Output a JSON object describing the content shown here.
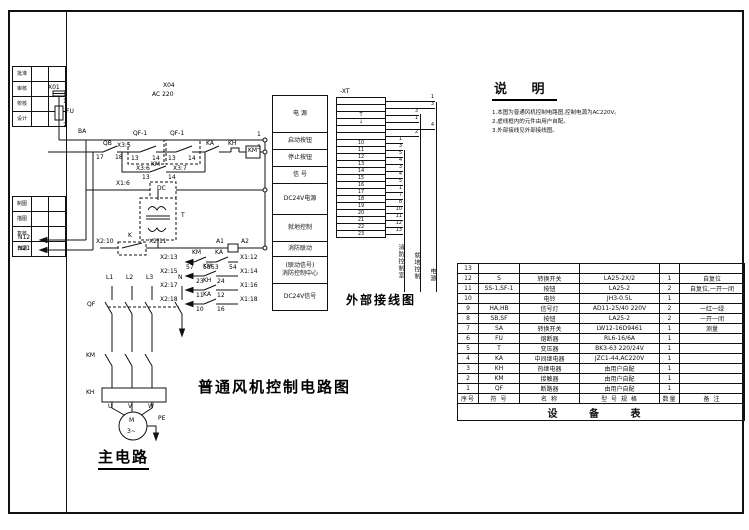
{
  "drawing": {
    "main_title": "普通风机控制电路图",
    "wiring_title": "外部接线图",
    "main_circuit_title": "主电路",
    "terminal_strip_name": "-XT"
  },
  "notes": {
    "title": "说 明",
    "lines": [
      "1.本图为普通风机控制电路图,控制电源为AC220V。",
      "2.虚线框内的元件由用户自配。",
      "3.外部接线见外部接线图。"
    ]
  },
  "labels": {
    "control": [
      {
        "t": "X01",
        "x": 48,
        "y": 85
      },
      {
        "t": "1",
        "x": 63,
        "y": 99
      },
      {
        "t": "FU",
        "x": 66,
        "y": 109
      },
      {
        "t": "2",
        "x": 63,
        "y": 123
      },
      {
        "t": "X04",
        "x": 163,
        "y": 83
      },
      {
        "t": "AC 220",
        "x": 152,
        "y": 92
      },
      {
        "t": "BA",
        "x": 78,
        "y": 129
      },
      {
        "t": "QB",
        "x": 103,
        "y": 141
      },
      {
        "t": "17",
        "x": 96,
        "y": 155
      },
      {
        "t": "18",
        "x": 115,
        "y": 155
      },
      {
        "t": "X3:5",
        "x": 117,
        "y": 143
      },
      {
        "t": "QF-1",
        "x": 133,
        "y": 131
      },
      {
        "t": "QF-1",
        "x": 170,
        "y": 131
      },
      {
        "t": "13",
        "x": 131,
        "y": 156
      },
      {
        "t": "14",
        "x": 152,
        "y": 156
      },
      {
        "t": "X3:6",
        "x": 136,
        "y": 166
      },
      {
        "t": "13",
        "x": 168,
        "y": 156
      },
      {
        "t": "14",
        "x": 188,
        "y": 156
      },
      {
        "t": "X3:7",
        "x": 173,
        "y": 166
      },
      {
        "t": "KA",
        "x": 206,
        "y": 141
      },
      {
        "t": "KH",
        "x": 228,
        "y": 141
      },
      {
        "t": "KM",
        "x": 248,
        "y": 148
      },
      {
        "t": "KM",
        "x": 151,
        "y": 162
      },
      {
        "t": "13",
        "x": 142,
        "y": 175
      },
      {
        "t": "14",
        "x": 168,
        "y": 175
      },
      {
        "t": "X1:6",
        "x": 116,
        "y": 181
      },
      {
        "t": "DC",
        "x": 157,
        "y": 186
      },
      {
        "t": "T",
        "x": 181,
        "y": 213
      },
      {
        "t": "X2:10",
        "x": 96,
        "y": 239
      },
      {
        "t": "K",
        "x": 128,
        "y": 233
      },
      {
        "t": "X2:11",
        "x": 149,
        "y": 239
      },
      {
        "t": "A1",
        "x": 216,
        "y": 239
      },
      {
        "t": "A2",
        "x": 241,
        "y": 239
      },
      {
        "t": "1",
        "x": 257,
        "y": 132
      },
      {
        "t": "3",
        "x": 257,
        "y": 145
      }
    ],
    "feedback": [
      {
        "t": "X2:13",
        "x": 160,
        "y": 255
      },
      {
        "t": "KM",
        "x": 192,
        "y": 250
      },
      {
        "t": "57",
        "x": 186,
        "y": 265
      },
      {
        "t": "58",
        "x": 203,
        "y": 265
      },
      {
        "t": "KA",
        "x": 215,
        "y": 250
      },
      {
        "t": "53",
        "x": 211,
        "y": 265
      },
      {
        "t": "54",
        "x": 229,
        "y": 265
      },
      {
        "t": "X1:12",
        "x": 240,
        "y": 255
      },
      {
        "t": "X2:15",
        "x": 160,
        "y": 269
      },
      {
        "t": "KM",
        "x": 203,
        "y": 264
      },
      {
        "t": "23",
        "x": 196,
        "y": 279
      },
      {
        "t": "24",
        "x": 217,
        "y": 279
      },
      {
        "t": "X1:14",
        "x": 240,
        "y": 269
      },
      {
        "t": "X2:17",
        "x": 160,
        "y": 283
      },
      {
        "t": "KH",
        "x": 203,
        "y": 278
      },
      {
        "t": "11",
        "x": 196,
        "y": 293
      },
      {
        "t": "12",
        "x": 217,
        "y": 293
      },
      {
        "t": "X1:16",
        "x": 240,
        "y": 283
      },
      {
        "t": "X2:18",
        "x": 160,
        "y": 297
      },
      {
        "t": "KA",
        "x": 203,
        "y": 292
      },
      {
        "t": "10",
        "x": 196,
        "y": 307
      },
      {
        "t": "16",
        "x": 217,
        "y": 307
      },
      {
        "t": "X1:18",
        "x": 240,
        "y": 297
      }
    ],
    "main_circuit": [
      {
        "t": "L1",
        "x": 106,
        "y": 275
      },
      {
        "t": "L2",
        "x": 126,
        "y": 275
      },
      {
        "t": "L3",
        "x": 146,
        "y": 275
      },
      {
        "t": "N",
        "x": 178,
        "y": 275
      },
      {
        "t": "QF",
        "x": 87,
        "y": 302
      },
      {
        "t": "KM",
        "x": 86,
        "y": 353
      },
      {
        "t": "KH",
        "x": 86,
        "y": 390
      },
      {
        "t": "U",
        "x": 108,
        "y": 404
      },
      {
        "t": "V",
        "x": 128,
        "y": 404
      },
      {
        "t": "W",
        "x": 148,
        "y": 404
      },
      {
        "t": "M",
        "x": 129,
        "y": 418
      },
      {
        "t": "3~",
        "x": 127,
        "y": 429
      },
      {
        "t": "PE",
        "x": 158,
        "y": 416
      }
    ],
    "wire_tags": [
      {
        "t": "N12",
        "x": 18,
        "y": 235
      },
      {
        "t": "N21",
        "x": 18,
        "y": 246
      }
    ]
  },
  "external_boxes": [
    {
      "lines": [
        "电  源"
      ]
    },
    {
      "lines": [
        "启动按钮"
      ]
    },
    {
      "lines": [
        "停止按钮"
      ]
    },
    {
      "lines": [
        "信  号"
      ]
    },
    {
      "lines": [
        "DC24V电源"
      ]
    },
    {
      "lines": [
        "就地控制"
      ]
    },
    {
      "lines": [
        "消防联动"
      ]
    },
    {
      "lines": [
        "(联动信号)",
        "消防控制中心"
      ]
    },
    {
      "lines": [
        "DC24V信号"
      ]
    }
  ],
  "terminal_strip": {
    "rows": [
      {
        "label": "",
        "wire": "1",
        "bus": 3
      },
      {
        "label": "",
        "wire": "3",
        "bus": 3
      },
      {
        "label": "T",
        "wire": "3",
        "bus": 2
      },
      {
        "label": "↓",
        "wire": "1",
        "bus": 2
      },
      {
        "label": "",
        "wire": "4",
        "bus": 3
      },
      {
        "label": "",
        "wire": "2",
        "bus": 2
      },
      {
        "label": "10",
        "wire": "1",
        "bus": 1
      },
      {
        "label": "11",
        "wire": "3",
        "bus": 1
      },
      {
        "label": "12",
        "wire": "5",
        "bus": 1
      },
      {
        "label": "13",
        "wire": "4",
        "bus": 1
      },
      {
        "label": "14",
        "wire": "3",
        "bus": 1
      },
      {
        "label": "15",
        "wire": "4",
        "bus": 1
      },
      {
        "label": "16",
        "wire": "5",
        "bus": 1
      },
      {
        "label": "17",
        "wire": "1",
        "bus": 1
      },
      {
        "label": "18",
        "wire": "7",
        "bus": 1
      },
      {
        "label": "19",
        "wire": "8",
        "bus": 1
      },
      {
        "label": "20",
        "wire": "10",
        "bus": 1
      },
      {
        "label": "21",
        "wire": "11",
        "bus": 1
      },
      {
        "label": "22",
        "wire": "12",
        "bus": 1
      },
      {
        "label": "23",
        "wire": "13",
        "bus": 1
      }
    ]
  },
  "bus_labels": [
    "消防控制室",
    "就地控制",
    "电源"
  ],
  "equipment_table": {
    "headers": [
      "序号",
      "符 号",
      "名 称",
      "型 号 规 格",
      "数量",
      "备 注"
    ],
    "rows": [
      [
        "13",
        "",
        "",
        "",
        "",
        ""
      ],
      [
        "12",
        "S",
        "转换开关",
        "LA25-2X/2",
        "1",
        "自复位"
      ],
      [
        "11",
        "SS-1,SF-1",
        "按钮",
        "LA25-2",
        "2",
        "自复位,一开一闭"
      ],
      [
        "10",
        "",
        "电铃",
        "JH3-0.5L",
        "1",
        ""
      ],
      [
        "9",
        "HA,HB",
        "信号灯",
        "AD11-25/40 220V",
        "2",
        "一红一绿"
      ],
      [
        "8",
        "SB,SF",
        "按钮",
        "LA25-2",
        "2",
        "一开一闭"
      ],
      [
        "7",
        "SA",
        "转换开关",
        "LW12-16D9461",
        "1",
        "测量"
      ],
      [
        "6",
        "FU",
        "熔断器",
        "RL6-16/6A",
        "1",
        ""
      ],
      [
        "5",
        "T",
        "变压器",
        "BK3-63 220/24V",
        "1",
        ""
      ],
      [
        "4",
        "KA",
        "中间继电器",
        "JZC1-44,AC220V",
        "1",
        ""
      ],
      [
        "3",
        "KH",
        "热继电器",
        "由用户自配",
        "1",
        ""
      ],
      [
        "2",
        "KM",
        "接触器",
        "由用户自配",
        "1",
        ""
      ],
      [
        "1",
        "QF",
        "断路器",
        "由用户自配",
        "1",
        ""
      ]
    ],
    "footer": "设 备 表"
  },
  "title_block": {
    "sidebar_a": [
      "批准",
      "审核",
      "校核",
      "设计"
    ],
    "sidebar_b": [
      "制图",
      "描图",
      "复核",
      "日期"
    ]
  }
}
